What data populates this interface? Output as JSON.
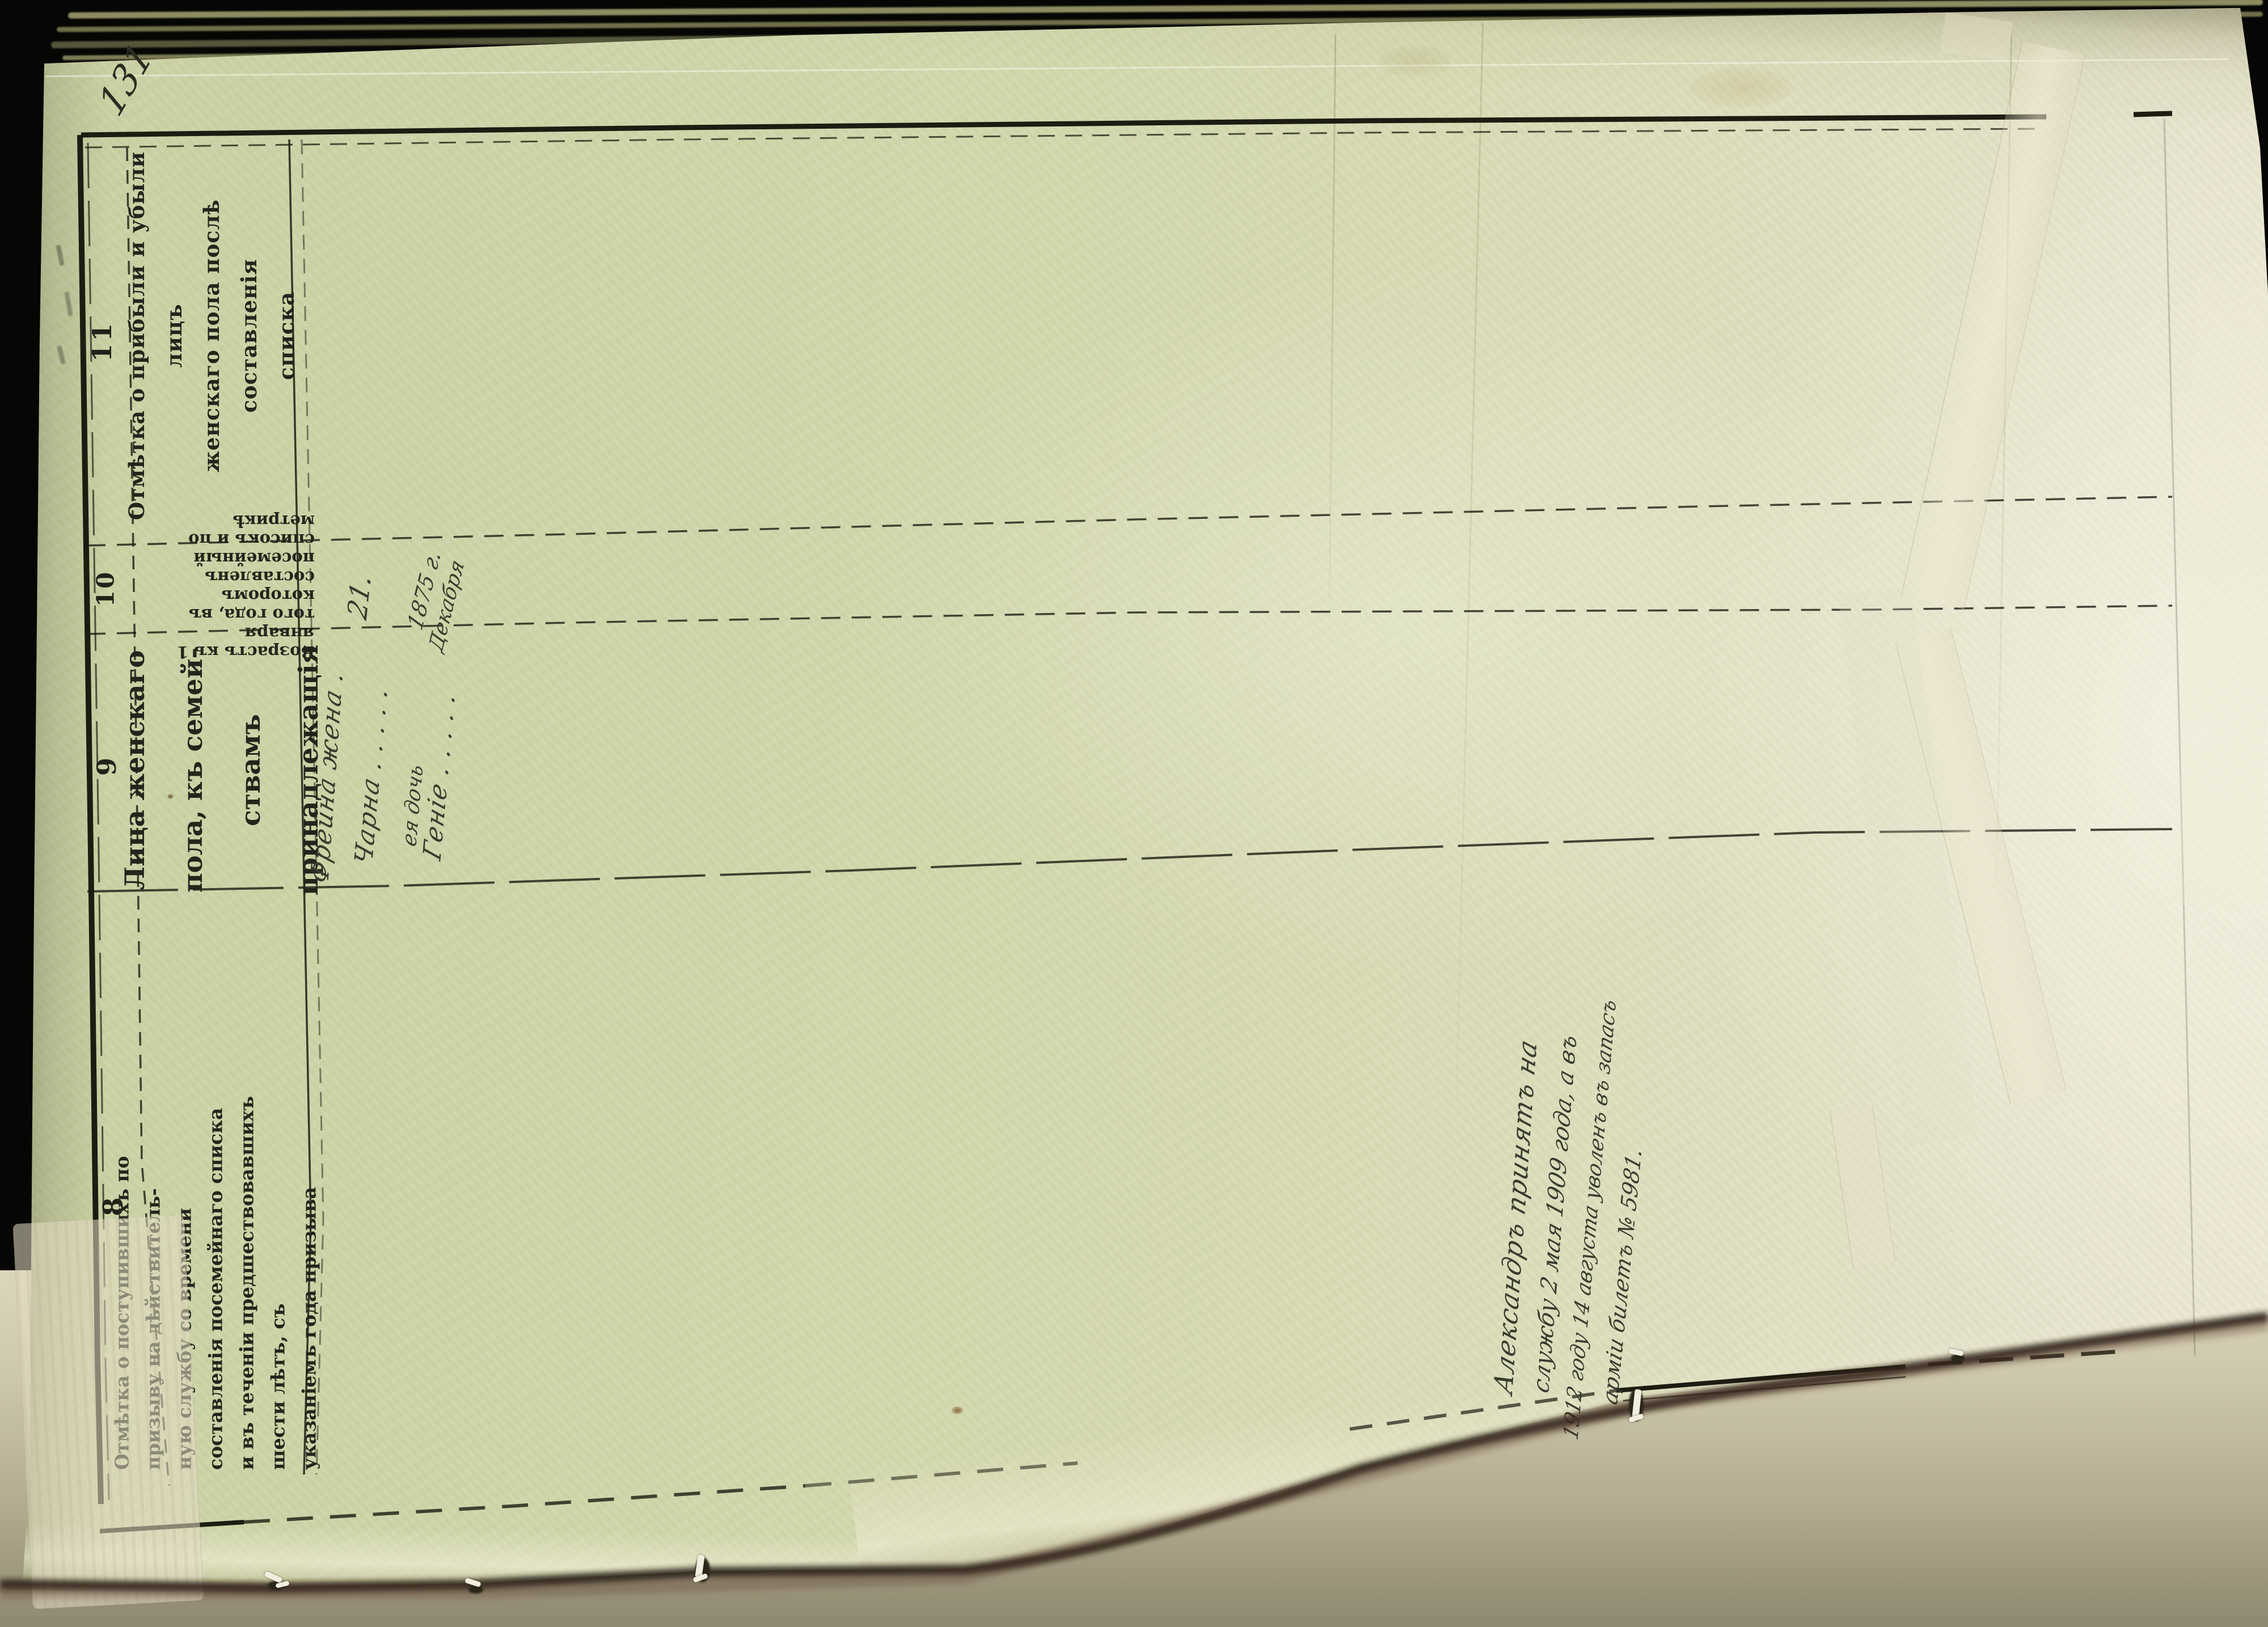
{
  "document": {
    "kind": "archival family (conscription) register page, pre-1918 Russian orthography",
    "page_number_handwritten": "131"
  },
  "colors": {
    "backdrop": "#060604",
    "paper_left": "#ced5a8",
    "paper_right": "#ebe7d4",
    "ink_printed": "#20221a",
    "ink_handwriting": "#383b2e",
    "tape": "#e8e1c8"
  },
  "table": {
    "columns": [
      {
        "number": "11",
        "header_lines": [
          "Отмѣтка о прибыли и убыли лицъ",
          "женскаго пола послѣ составленія",
          "списка"
        ]
      },
      {
        "number": "10",
        "header_lines": [
          "Возрастъ къ 1 января",
          "того года, въ которомъ",
          "составленъ посемейный",
          "списокъ и по метрикѣ"
        ]
      },
      {
        "number": "9",
        "header_lines": [
          "Лица женскаго пола, къ семей-",
          "ствамъ принадлежащія"
        ]
      },
      {
        "number": "8",
        "header_lines": [
          "Отмѣтка о поступившихъ по призыву на дѣйствитель-",
          "ную службу со времени составленія посемейнаго списка",
          "и въ теченіи предшествовавшихъ шести лѣтъ, съ",
          "указаніемъ года призыва"
        ]
      }
    ]
  },
  "entries": {
    "col9_women": {
      "line1": "Фрейна жена .",
      "line2": "Чарна . . . . .",
      "line2_note": "ея дочь",
      "line3": "Геніе . . . . ."
    },
    "col10_age": "21.",
    "col10_birth_year": "1875 г.",
    "col10_birth_month": "Декабря",
    "col8_service_note_lines": [
      "Александръ принятъ на",
      "службу 2 мая 1909 года, а въ",
      "1912 году 14 августа уволенъ въ запасъ",
      "арміи билетъ № 5981."
    ]
  }
}
